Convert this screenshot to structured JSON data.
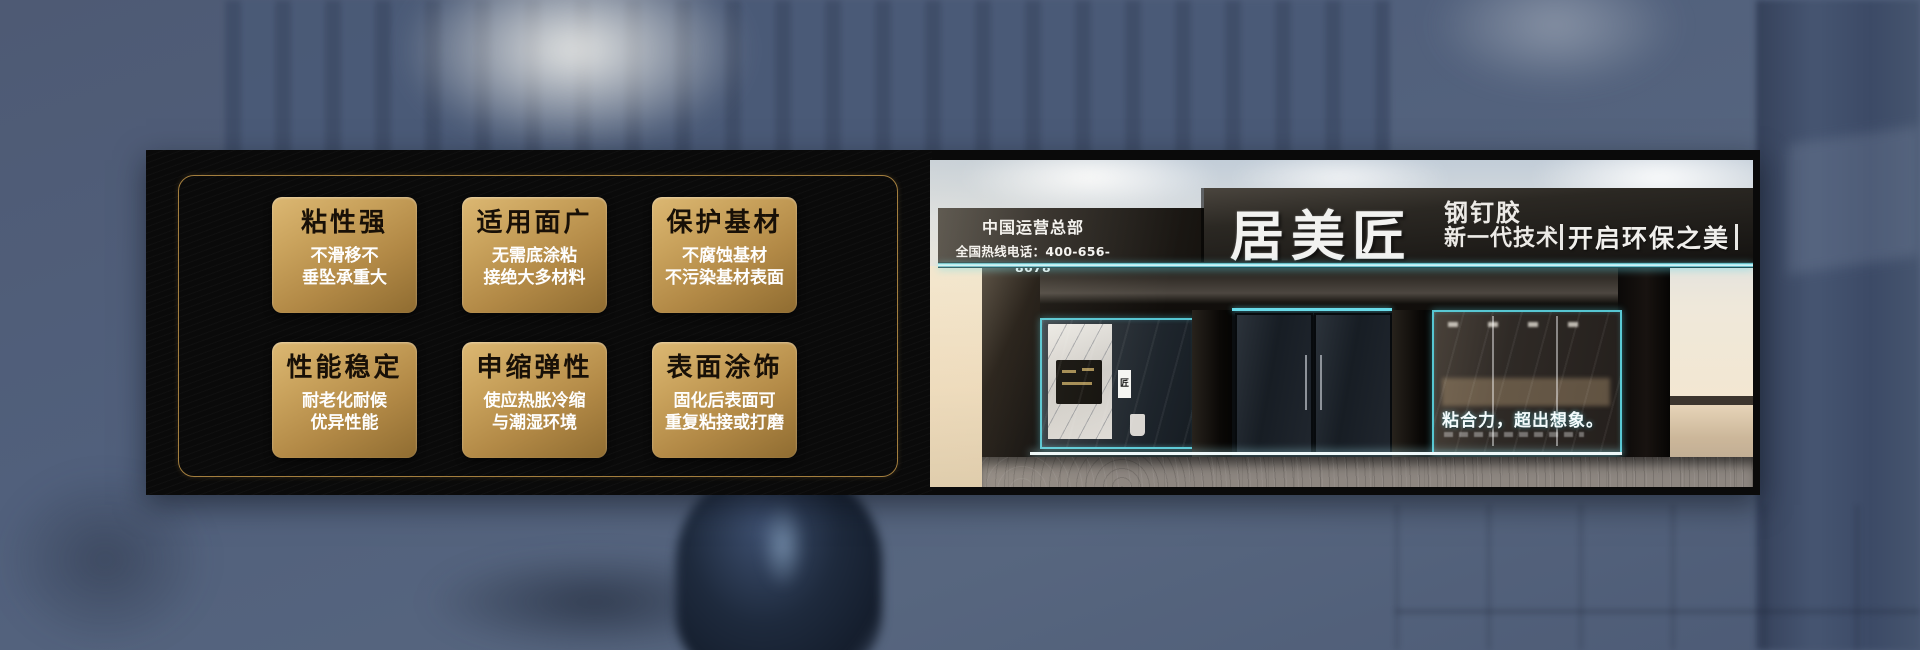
{
  "features_panel": {
    "cards": [
      {
        "title": "粘性强",
        "lines": [
          "不滑移不",
          "垂坠承重大"
        ]
      },
      {
        "title": "适用面广",
        "lines": [
          "无需底涂粘",
          "接绝大多材料"
        ]
      },
      {
        "title": "保护基材",
        "lines": [
          "不腐蚀基材",
          "不污染基材表面"
        ]
      },
      {
        "title": "性能稳定",
        "lines": [
          "耐老化耐候",
          "优异性能"
        ]
      },
      {
        "title": "申缩弹性",
        "lines": [
          "使应热胀冷缩",
          "与潮湿环境"
        ]
      },
      {
        "title": "表面涂饰",
        "lines": [
          "固化后表面可",
          "重复粘接或打磨"
        ]
      }
    ]
  },
  "storefront": {
    "hq_label": "中国运营总部",
    "hotline": "全国热线电话：400-656-8678",
    "brand": "居美匠",
    "product": "钢钉胶",
    "tech": "新一代技术",
    "eco_slogan": "开启环保之美",
    "window_slogan": "粘合力，超出想象。",
    "tag_char": "匠"
  },
  "colors": {
    "gold_light": "#dcb873",
    "gold_dark": "#8f6c31",
    "gold_border": "#a37e3e",
    "led_cyan": "#6adcea",
    "panel_black": "#0a0a0a",
    "card_title": "#181007",
    "background_slate": "#51607c"
  }
}
